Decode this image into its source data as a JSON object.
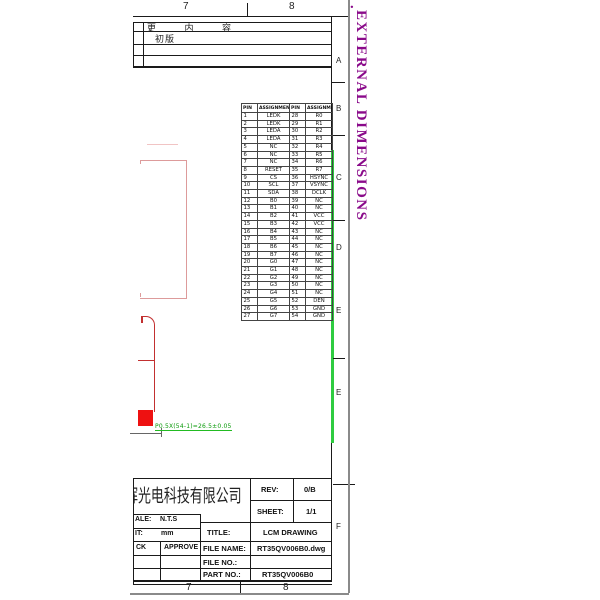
{
  "frame": {
    "top_grid": {
      "col7": "7",
      "col8": "8"
    },
    "bottom_grid": {
      "col7": "7",
      "col8": "8"
    },
    "zone_letters": [
      "A",
      "B",
      "C",
      "D",
      "E",
      "E",
      "F"
    ]
  },
  "revision_table": {
    "header": "更 内 容",
    "rows": [
      "初版",
      "",
      ""
    ]
  },
  "annotations": {
    "section_dot": ".",
    "section_title": "EXTERNAL DIMENSIONS",
    "fpc_dim_label": "P0.5X(54-1)=26.5±0.05"
  },
  "pin_table": {
    "headers": [
      "PIN",
      "ASSIGNMENT",
      "PIN",
      "ASSIGNMENT"
    ],
    "rows": [
      [
        "1",
        "LEDK",
        "28",
        "R0"
      ],
      [
        "2",
        "LEDK",
        "29",
        "R1"
      ],
      [
        "3",
        "LEDA",
        "30",
        "R2"
      ],
      [
        "4",
        "LEDA",
        "31",
        "R3"
      ],
      [
        "5",
        "NC",
        "32",
        "R4"
      ],
      [
        "6",
        "NC",
        "33",
        "R5"
      ],
      [
        "7",
        "NC",
        "34",
        "R6"
      ],
      [
        "8",
        "RESET",
        "35",
        "R7"
      ],
      [
        "9",
        "CS",
        "36",
        "HSYNC"
      ],
      [
        "10",
        "SCL",
        "37",
        "VSYNC"
      ],
      [
        "11",
        "SDA",
        "38",
        "DCLK"
      ],
      [
        "12",
        "B0",
        "39",
        "NC"
      ],
      [
        "13",
        "B1",
        "40",
        "NC"
      ],
      [
        "14",
        "B2",
        "41",
        "VCC"
      ],
      [
        "15",
        "B3",
        "42",
        "VCC"
      ],
      [
        "16",
        "B4",
        "43",
        "NC"
      ],
      [
        "17",
        "B5",
        "44",
        "NC"
      ],
      [
        "18",
        "B6",
        "45",
        "NC"
      ],
      [
        "19",
        "B7",
        "46",
        "NC"
      ],
      [
        "20",
        "G0",
        "47",
        "NC"
      ],
      [
        "21",
        "G1",
        "48",
        "NC"
      ],
      [
        "22",
        "G2",
        "49",
        "NC"
      ],
      [
        "23",
        "G3",
        "50",
        "NC"
      ],
      [
        "24",
        "G4",
        "51",
        "NC"
      ],
      [
        "25",
        "G5",
        "52",
        "DEN"
      ],
      [
        "26",
        "G6",
        "53",
        "GND"
      ],
      [
        "27",
        "G7",
        "54",
        "GND"
      ]
    ]
  },
  "title_block": {
    "company": "辉光电科技有限公司",
    "scale_label": "ALE:",
    "scale_value": "N.T.S",
    "unit_label": "IT:",
    "unit_value": "mm",
    "check_label": "CK",
    "approve_label": "APPROVE",
    "rev_label": "REV:",
    "rev_value": "0/B",
    "sheet_label": "SHEET:",
    "sheet_value": "1/1",
    "title_label": "TITLE:",
    "title_value": "LCM  DRAWING",
    "file_name_label": "FILE  NAME:",
    "file_name_value": "RT35QV006B0.dwg",
    "file_no_label": "FILE  NO.:",
    "file_no_value": "",
    "part_no_label": "PART  NO.:",
    "part_no_value": "RT35QV006B0"
  },
  "colors": {
    "highlight_green": "#2ecc40",
    "annotation_green": "#0a9a0a",
    "section_purple": "#8a0a8a",
    "pad_red": "#ee1111",
    "outline_pink": "#dd9b9b"
  }
}
